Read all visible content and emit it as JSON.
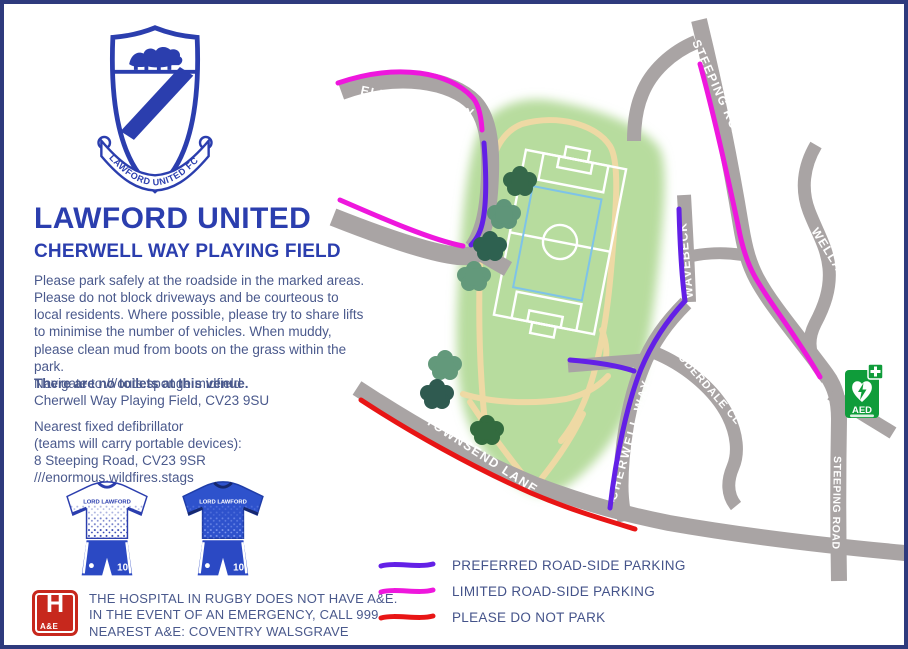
{
  "page": {
    "border_color": "#2e3a7d",
    "background": "#ffffff"
  },
  "crest": {
    "ribbon_text": "LAWFORD UNITED FC"
  },
  "header": {
    "title": "LAWFORD UNITED",
    "subtitle": "CHERWELL WAY PLAYING FIELD"
  },
  "info": {
    "parking_paragraph": "Please park safely at the roadside in the marked areas. Please do not block driveways and be courteous to local residents. Where possible, please try to share lifts to minimise the number of vehicles. When muddy, please clean mud from boots on the grass within the park.",
    "no_toilets": "There are no toilets at this venue.",
    "navigate": {
      "line1": "Navigate to ///outs.sponge.midfield",
      "line2": "Cherwell Way Playing Field, CV23 9SU"
    },
    "defibrillator": {
      "line1": "Nearest fixed defibrillator",
      "line2": "(teams will carry portable devices):",
      "line3": "8 Steeping Road, CV23 9SR",
      "line4": "///enormous.wildfires.stags"
    }
  },
  "kits": {
    "sponsor": "LORD LAWFORD",
    "home_number": "10",
    "away_number": "10"
  },
  "hospital_notice": {
    "icon_letter": "H",
    "icon_sub": "A&E",
    "line1": "THE HOSPITAL IN RUGBY DOES NOT HAVE A&E.",
    "line2": "IN THE EVENT OF AN EMERGENCY, CALL 999.",
    "line3": "NEAREST A&E: COVENTRY WALSGRAVE"
  },
  "map": {
    "labels": {
      "elizabeth_way": "ELIZABETH WAY",
      "steeping_road_top": "STEEPING ROAD",
      "wavebeck": "WAVEBECK",
      "welland": "WELLAND",
      "cherwell_way": "CHERWELL WAY",
      "lauderdale_close": "LAUDERDALE CL",
      "townsend_lane": "TOWNSEND LANE",
      "steeping_road_bottom": "STEEPING ROAD"
    },
    "aed_label": "AED",
    "colors": {
      "road": "#a9a4a4",
      "park": "#b7dc9e",
      "path": "#eed9a4",
      "pitch_line": "#ffffff",
      "inner_pitch": "#7ec3e8",
      "aed_green": "#0f9c3a"
    }
  },
  "legend": {
    "items": [
      {
        "label": "PREFERRED ROAD-SIDE PARKING",
        "color": "#6320e6"
      },
      {
        "label": "LIMITED ROAD-SIDE PARKING",
        "color": "#ee17dd"
      },
      {
        "label": "PLEASE DO NOT PARK",
        "color": "#e81515"
      }
    ]
  }
}
